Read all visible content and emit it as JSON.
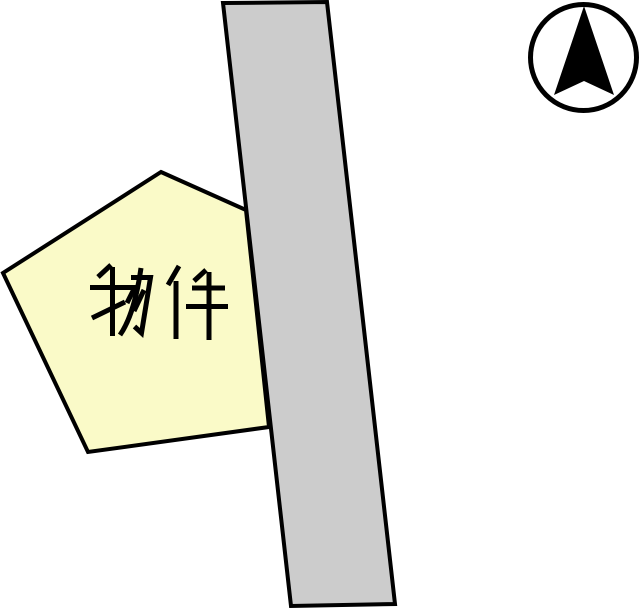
{
  "scene": {
    "background_color": "#ffffff",
    "property": {
      "label": "物件",
      "fill_color": "#fafac8",
      "outline_color": "#000000",
      "label_color": "#000000",
      "shape_points": "161,172 246,210 269,427 88,452 3,273"
    },
    "road": {
      "fill_color": "#cccccc",
      "outline_color": "#000000",
      "shape_points": "223,3 327,2 395,604 291,606"
    },
    "compass": {
      "icon": "north-arrow-icon",
      "ring_color": "#000000",
      "arrow_color": "#000000",
      "arrow_points": "584,6 614,95 584,81 554,95"
    }
  }
}
